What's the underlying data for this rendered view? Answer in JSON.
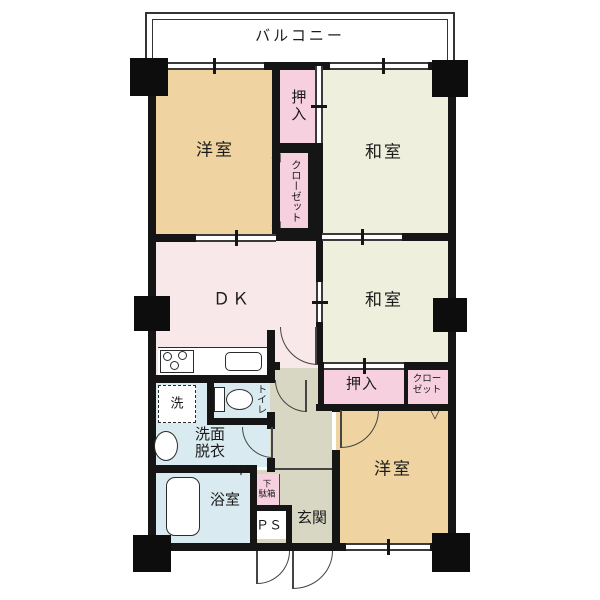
{
  "plan_title": "マンション間取り図",
  "balcony": {
    "label": "バルコニー"
  },
  "rooms": {
    "western1": {
      "label": "洋室"
    },
    "japanese1": {
      "label": "和室"
    },
    "japanese2": {
      "label": "和室"
    },
    "western2": {
      "label": "洋室"
    },
    "dk": {
      "label": "ＤＫ"
    },
    "oshiire1": {
      "label": "押入"
    },
    "closet1": {
      "label": "クローゼット"
    },
    "oshiire2": {
      "label": "押入"
    },
    "closet2": {
      "line1": "クロー",
      "line2": "ゼット"
    },
    "toilet": {
      "label": "トイレ"
    },
    "washroom": {
      "line1": "洗面",
      "line2": "脱衣"
    },
    "bath": {
      "label": "浴室"
    },
    "laundry": {
      "label": "洗"
    },
    "shoebox": {
      "line1": "下",
      "line2": "駄箱"
    },
    "ps": {
      "label": "ＰＳ"
    },
    "entrance": {
      "label": "玄関"
    }
  },
  "colors": {
    "western": "#EFD3A0",
    "tatami": "#EEEFDC",
    "dk": "#F9E8EA",
    "closet": "#F7D0E0",
    "water": "#D9EAF0",
    "hall": "#D8D7C4",
    "white": "#FFFFFF",
    "wall": "#151515"
  }
}
